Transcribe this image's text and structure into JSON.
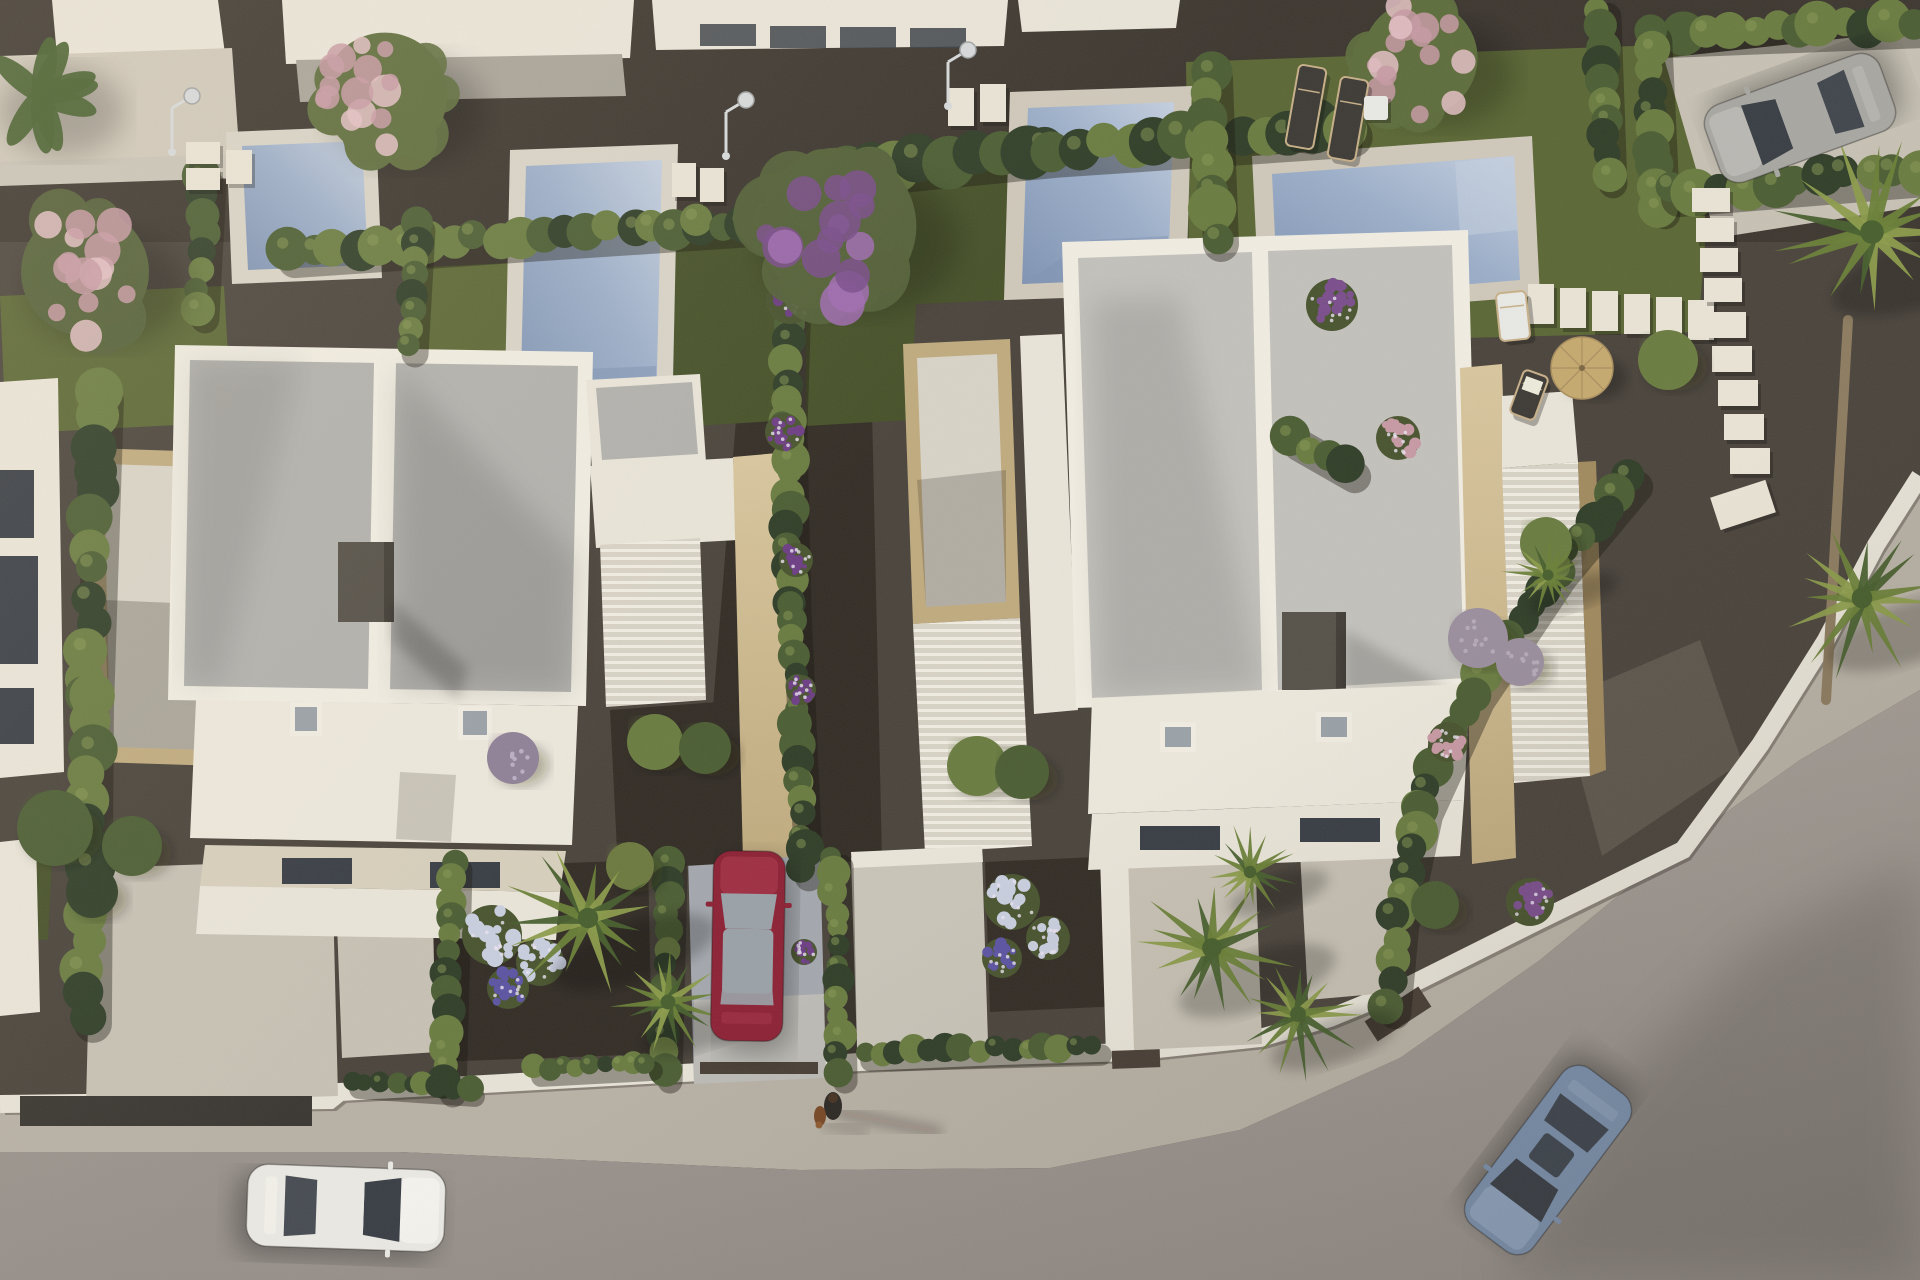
{
  "scene": {
    "title": "Aerial 3D render of a modern villa development at golden hour",
    "description": "Top-down architectural visualization: two white flat-roof villas with travertine pergolas, four private pools with white decks, cypress hedges, lawns, palm trees, flowering shrubs, a curving street corner with sidewalk, four cars and a person walking a dog.",
    "objects_visible": [
      "villa with flat gravel roof (left)",
      "villa with flat gravel roof (right)",
      "4 swimming pools",
      "cypress hedge rows",
      "purple blossom tree",
      "pink blossom trees",
      "fan palms",
      "outdoor showers",
      "sun loungers",
      "straw parasol",
      "stepping-stone paths",
      "red parked car",
      "white car on road",
      "blue car on road",
      "silver car in driveway",
      "person walking a dog",
      "white boundary wall with dark gates",
      "curved sidewalk and asphalt road"
    ]
  },
  "palette": {
    "gravelBase": "#4b453d",
    "gravelDark": "#3e3831",
    "mulch": "#342e27",
    "gravelWarm": "#71685c",
    "grass": "#5c6836",
    "grassShade": "#47522a",
    "grassLight": "#6d7a40",
    "hedgeDark": "#32402a",
    "hedgeMid": "#4d5f35",
    "hedgeLight": "#6b7d42",
    "hedgeGlow": "#8a9a55",
    "treeLeaf": "#5f6e3e",
    "treeLeaf2": "#55623a",
    "bananaLeaf": "#47602f",
    "pinkBloom": "#c79aa4",
    "pinkBloomLight": "#e3bfc4",
    "purpleBloom": "#7b4f8c",
    "purpleBloomLight": "#a06cb0",
    "bougainvillea": "#6e3f85",
    "palmDark": "#49602f",
    "palmMid": "#6b8139",
    "palmLight": "#8c9c4c",
    "palmTrunk": "#8d7c60",
    "lilacBush": "#9b8f9e",
    "lavenderBush": "#8f8197",
    "hydrangeaWhite": "#c9cede",
    "hydrangeaPurple": "#5d55a2",
    "flowerLeaf": "#4a5530",
    "poolWaterLight": "#c4cfdf",
    "poolWater": "#9dafc9",
    "poolWaterDark": "#8094b3",
    "deckWhite": "#d8d3c7",
    "deckWarm": "#cfc8ba",
    "deckBright": "#e9e3d5",
    "terraceStone": "#d7cfbc",
    "parapetWhite": "#f0ece1",
    "wallWhite": "#e9e4d8",
    "wallShade": "#c9c4b8",
    "wallDark": "#a8a399",
    "roofGravelA": "#b2b1ad",
    "roofGravelB": "#c3c1bb",
    "roofWhiteTer": "#ece7db",
    "stoneLight": "#d8c69e",
    "stoneMid": "#c0ab7f",
    "stoneDark": "#a18a5f",
    "slatBase": "#d7d2c5",
    "slatLine": "#f0ece1",
    "chimney": "#57524a",
    "chimneyDark": "#433f38",
    "glassDark": "#3a3f46",
    "skylight": "#9aa1a7",
    "road": "#a59d96",
    "roadDark": "#97908a",
    "sidewalk": "#b8b1a5",
    "curbWhite": "#e7e2d6",
    "driveLight": "#c7c1b4",
    "driveCool": "#a4a8ae",
    "driveCoolLight": "#c2beb6",
    "carRed": "#8d2336",
    "carRedLight": "#a23247",
    "carWhite": "#eae8e2",
    "carWhiteLight": "#f5f3ed",
    "carBlue": "#7b90ab",
    "carBlueLight": "#90a4bd",
    "carSilver": "#a8a7a2",
    "carSilverLight": "#bcbbb6",
    "loungerDark": "#3f3c37",
    "loungerFrame": "#c7b089",
    "parasolStraw": "#c5a96f",
    "tableWhite": "#e8e8e4",
    "gateDark": "#3b3833",
    "gateBrown": "#4a4037",
    "personDark": "#2e2a26",
    "dogBrown": "#7a4a28",
    "showerChrome": "#d6d9da"
  },
  "vegetation": {
    "hedges": [
      {
        "name": "left-boundary-hedge",
        "pts": [
          [
            98,
            392
          ],
          [
            88,
            700
          ],
          [
            86,
            1015
          ]
        ],
        "r": 21,
        "step": 26
      },
      {
        "name": "pool1-left-hedge",
        "pts": [
          [
            205,
            178
          ],
          [
            198,
            310
          ]
        ],
        "r": 16,
        "step": 20
      },
      {
        "name": "top-hedge-left",
        "pts": [
          [
            288,
            252
          ],
          [
            520,
            236
          ],
          [
            700,
            224
          ],
          [
            790,
            218
          ]
        ],
        "r": 19,
        "step": 24
      },
      {
        "name": "pool1-right-hedge",
        "pts": [
          [
            415,
            222
          ],
          [
            408,
            345
          ]
        ],
        "r": 15,
        "step": 20
      },
      {
        "name": "top-hedge-right",
        "pts": [
          [
            845,
            168
          ],
          [
            1050,
            148
          ],
          [
            1345,
            128
          ]
        ],
        "r": 23,
        "step": 28
      },
      {
        "name": "central-hedge",
        "pts": [
          [
            792,
            228
          ],
          [
            786,
            420
          ],
          [
            790,
            600
          ],
          [
            798,
            780
          ],
          [
            802,
            868
          ]
        ],
        "r": 16,
        "step": 20
      },
      {
        "name": "front-hedge-a",
        "pts": [
          [
            452,
            862
          ],
          [
            446,
            1085
          ]
        ],
        "r": 15,
        "step": 19
      },
      {
        "name": "front-hedge-b",
        "pts": [
          [
            668,
            862
          ],
          [
            663,
            1072
          ]
        ],
        "r": 14,
        "step": 18
      },
      {
        "name": "front-hedge-c",
        "pts": [
          [
            834,
            858
          ],
          [
            838,
            1072
          ]
        ],
        "r": 14,
        "step": 18
      },
      {
        "name": "pool3-pool4-hedge",
        "pts": [
          [
            1208,
            70
          ],
          [
            1214,
            235
          ]
        ],
        "r": 20,
        "step": 24
      },
      {
        "name": "villaB-east-hedge",
        "pts": [
          [
            1292,
            436
          ],
          [
            1348,
            468
          ]
        ],
        "r": 18,
        "step": 22
      },
      {
        "name": "right-plot-hedge-v",
        "pts": [
          [
            1600,
            8
          ],
          [
            1606,
            175
          ]
        ],
        "r": 16,
        "step": 20
      },
      {
        "name": "top-right-hedge",
        "pts": [
          [
            1658,
            32
          ],
          [
            1915,
            22
          ]
        ],
        "r": 19,
        "step": 24
      },
      {
        "name": "driveway-hedge-left",
        "pts": [
          [
            1650,
            32
          ],
          [
            1658,
            205
          ]
        ],
        "r": 17,
        "step": 21
      },
      {
        "name": "driveway-hedge-right",
        "pts": [
          [
            1672,
            190
          ],
          [
            1919,
            170
          ]
        ],
        "r": 20,
        "step": 25
      },
      {
        "name": "road-curve-hedge",
        "pts": [
          [
            1630,
            478
          ],
          [
            1555,
            568
          ],
          [
            1472,
            692
          ],
          [
            1420,
            806
          ],
          [
            1396,
            918
          ],
          [
            1388,
            1004
          ]
        ],
        "r": 18,
        "step": 23
      },
      {
        "name": "front-bushes-a",
        "pts": [
          [
            352,
            1080
          ],
          [
            468,
            1088
          ]
        ],
        "r": 11,
        "step": 16
      },
      {
        "name": "front-bushes-b",
        "pts": [
          [
            534,
            1068
          ],
          [
            646,
            1062
          ]
        ],
        "r": 11,
        "step": 16
      },
      {
        "name": "front-bushes-c",
        "pts": [
          [
            864,
            1052
          ],
          [
            1094,
            1046
          ]
        ],
        "r": 12,
        "step": 17
      }
    ],
    "trees": [
      {
        "name": "blossom-tree-top-left",
        "cx": 385,
        "cy": 95,
        "r": 78,
        "leaf": "treeLeaf",
        "flower": "pinkBloom",
        "flower2": "pinkBloomLight"
      },
      {
        "name": "blossom-tree-left",
        "cx": 85,
        "cy": 272,
        "r": 80,
        "leaf": "treeLeaf2",
        "flower": "pinkBloom",
        "flower2": "pinkBloomLight"
      },
      {
        "name": "banana-plants",
        "cx": 40,
        "cy": 95,
        "r": 62,
        "leaf": "bananaLeaf",
        "type": "banana"
      },
      {
        "name": "purple-blossom-tree",
        "cx": 838,
        "cy": 226,
        "r": 98,
        "leaf": "treeLeaf2",
        "flower": "purpleBloom",
        "flower2": "purpleBloomLight"
      },
      {
        "name": "blossom-tree-top-right",
        "cx": 1420,
        "cy": 58,
        "r": 72,
        "leaf": "treeLeaf",
        "flower": "pinkBloom",
        "flower2": "pinkBloomLight"
      }
    ],
    "palms": [
      {
        "name": "palm-frontyard-a1",
        "cx": 588,
        "cy": 918,
        "r": 85
      },
      {
        "name": "palm-frontyard-a2",
        "cx": 668,
        "cy": 1002,
        "r": 62
      },
      {
        "name": "palm-frontyard-b1",
        "cx": 1212,
        "cy": 948,
        "r": 82
      },
      {
        "name": "palm-frontyard-b2",
        "cx": 1298,
        "cy": 1014,
        "r": 66
      },
      {
        "name": "palm-frontyard-b3",
        "cx": 1250,
        "cy": 872,
        "r": 52
      },
      {
        "name": "palm-right-top",
        "cx": 1872,
        "cy": 232,
        "r": 98,
        "trunk": [
          [
            1848,
            320
          ],
          [
            1826,
            700
          ]
        ]
      },
      {
        "name": "palm-right-mid",
        "cx": 1862,
        "cy": 598,
        "r": 86
      },
      {
        "name": "palm-small-right",
        "cx": 1548,
        "cy": 575,
        "r": 46
      }
    ],
    "bushes": [
      {
        "name": "backyard-bush-1",
        "cx": 55,
        "cy": 828,
        "r": 38,
        "color": "hedgeMid"
      },
      {
        "name": "backyard-bush-2",
        "cx": 132,
        "cy": 846,
        "r": 30,
        "color": "hedgeMid"
      },
      {
        "name": "backyard-bush-3",
        "cx": 92,
        "cy": 892,
        "r": 26,
        "color": "hedgeDark"
      },
      {
        "name": "villaA-planter-bush-1",
        "cx": 655,
        "cy": 742,
        "r": 28,
        "color": "hedgeLight"
      },
      {
        "name": "villaA-planter-bush-2",
        "cx": 705,
        "cy": 748,
        "r": 26,
        "color": "hedgeMid"
      },
      {
        "name": "villaB-planter-bush-1",
        "cx": 977,
        "cy": 766,
        "r": 30,
        "color": "hedgeLight"
      },
      {
        "name": "villaB-planter-bush-2",
        "cx": 1022,
        "cy": 772,
        "r": 27,
        "color": "hedgeMid"
      },
      {
        "name": "lavender-ball-bush",
        "cx": 513,
        "cy": 758,
        "r": 26,
        "color": "lavenderBush",
        "dots": "#b9aec4"
      },
      {
        "name": "right-garden-bush-1",
        "cx": 1668,
        "cy": 360,
        "r": 30,
        "color": "hedgeLight"
      },
      {
        "name": "right-garden-bush-2",
        "cx": 1546,
        "cy": 543,
        "r": 26,
        "color": "hedgeLight"
      },
      {
        "name": "lilac-bush-1",
        "cx": 1478,
        "cy": 638,
        "r": 30,
        "color": "lilacBush",
        "dots": "#b5a9b8"
      },
      {
        "name": "lilac-bush-2",
        "cx": 1520,
        "cy": 662,
        "r": 24,
        "color": "lilacBush",
        "dots": "#b5a9b8"
      },
      {
        "name": "road-curve-bush",
        "cx": 1435,
        "cy": 905,
        "r": 24,
        "color": "hedgeMid"
      },
      {
        "name": "yucca-bush",
        "cx": 630,
        "cy": 866,
        "r": 24,
        "color": "grassLight"
      }
    ],
    "flowers": [
      {
        "name": "purple-flower-bush-1",
        "cx": 1332,
        "cy": 305,
        "r": 26,
        "color": "purpleBloom"
      },
      {
        "name": "pink-flower-bush-1",
        "cx": 1398,
        "cy": 438,
        "r": 22,
        "color": "pinkBloom"
      },
      {
        "name": "pink-flower-bush-2",
        "cx": 1448,
        "cy": 742,
        "r": 20,
        "color": "pinkBloom"
      },
      {
        "name": "purple-flower-bush-2",
        "cx": 1530,
        "cy": 902,
        "r": 24,
        "color": "purpleBloom"
      },
      {
        "name": "bougainvillea-1",
        "cx": 790,
        "cy": 300,
        "r": 24,
        "color": "bougainvillea"
      },
      {
        "name": "bougainvillea-2",
        "cx": 784,
        "cy": 432,
        "r": 19,
        "color": "bougainvillea"
      },
      {
        "name": "bougainvillea-3",
        "cx": 796,
        "cy": 560,
        "r": 17,
        "color": "bougainvillea"
      },
      {
        "name": "bougainvillea-4",
        "cx": 801,
        "cy": 690,
        "r": 15,
        "color": "bougainvillea"
      },
      {
        "name": "bougainvillea-5",
        "cx": 804,
        "cy": 952,
        "r": 13,
        "color": "bougainvillea"
      },
      {
        "name": "hydrangea-a-1",
        "cx": 492,
        "cy": 935,
        "r": 30,
        "color": "hydrangeaWhite"
      },
      {
        "name": "hydrangea-a-2",
        "cx": 540,
        "cy": 962,
        "r": 24,
        "color": "hydrangeaWhite"
      },
      {
        "name": "hydrangea-a-3",
        "cx": 508,
        "cy": 988,
        "r": 21,
        "color": "hydrangeaPurple"
      },
      {
        "name": "hydrangea-b-1",
        "cx": 1012,
        "cy": 902,
        "r": 28,
        "color": "hydrangeaWhite"
      },
      {
        "name": "hydrangea-b-2",
        "cx": 1048,
        "cy": 938,
        "r": 22,
        "color": "hydrangeaWhite"
      },
      {
        "name": "hydrangea-b-3",
        "cx": 1002,
        "cy": 958,
        "r": 20,
        "color": "hydrangeaPurple"
      }
    ],
    "stones": [
      {
        "x": 186,
        "y": 142,
        "w": 34,
        "h": 22
      },
      {
        "x": 186,
        "y": 168,
        "w": 34,
        "h": 22
      },
      {
        "x": 226,
        "y": 150,
        "w": 26,
        "h": 34
      },
      {
        "x": 672,
        "y": 163,
        "w": 24,
        "h": 34
      },
      {
        "x": 700,
        "y": 168,
        "w": 24,
        "h": 34
      },
      {
        "x": 948,
        "y": 88,
        "w": 26,
        "h": 38
      },
      {
        "x": 980,
        "y": 84,
        "w": 26,
        "h": 38
      },
      {
        "x": 1528,
        "y": 284,
        "w": 26,
        "h": 40
      },
      {
        "x": 1560,
        "y": 288,
        "w": 26,
        "h": 40
      },
      {
        "x": 1592,
        "y": 291,
        "w": 26,
        "h": 40
      },
      {
        "x": 1624,
        "y": 294,
        "w": 26,
        "h": 40
      },
      {
        "x": 1656,
        "y": 297,
        "w": 26,
        "h": 40
      },
      {
        "x": 1688,
        "y": 300,
        "w": 26,
        "h": 40
      },
      {
        "x": 1692,
        "y": 188,
        "w": 38,
        "h": 24
      },
      {
        "x": 1696,
        "y": 218,
        "w": 38,
        "h": 24
      },
      {
        "x": 1700,
        "y": 248,
        "w": 38,
        "h": 24
      },
      {
        "x": 1704,
        "y": 278,
        "w": 38,
        "h": 24
      },
      {
        "x": 1706,
        "y": 312,
        "w": 40,
        "h": 26
      },
      {
        "x": 1712,
        "y": 346,
        "w": 40,
        "h": 26
      },
      {
        "x": 1718,
        "y": 380,
        "w": 40,
        "h": 26
      },
      {
        "x": 1724,
        "y": 414,
        "w": 40,
        "h": 26
      },
      {
        "x": 1730,
        "y": 448,
        "w": 40,
        "h": 26
      },
      {
        "x": 1714,
        "y": 488,
        "w": 58,
        "h": 34,
        "rot": -18
      }
    ]
  },
  "furniture": {
    "loungers": [
      {
        "name": "sun-lounger-1",
        "x": 1292,
        "y": 66,
        "w": 28,
        "h": 82,
        "rot": 10,
        "color": "loungerDark"
      },
      {
        "name": "sun-lounger-2",
        "x": 1334,
        "y": 78,
        "w": 28,
        "h": 82,
        "rot": 10,
        "color": "loungerDark"
      },
      {
        "name": "pool-chair-white",
        "x": 1498,
        "y": 292,
        "w": 30,
        "h": 48,
        "rot": -6,
        "color": "tableWhite"
      },
      {
        "name": "deck-chair",
        "x": 1516,
        "y": 372,
        "w": 26,
        "h": 46,
        "rot": 20,
        "color": "loungerDark",
        "towel": true
      }
    ],
    "sideTable": {
      "x": 1364,
      "y": 96,
      "w": 24,
      "h": 24
    },
    "parasol": {
      "cx": 1582,
      "cy": 368,
      "r": 31
    },
    "showers": [
      {
        "x": 172,
        "y": 108
      },
      {
        "x": 726,
        "y": 112
      },
      {
        "x": 948,
        "y": 62
      }
    ]
  },
  "actors": {
    "cars": [
      {
        "name": "car-red-parked",
        "cx": 748,
        "cy": 946,
        "rot": 1,
        "len": 190,
        "w": 72,
        "body": "carRed",
        "bodyLight": "carRedLight",
        "glass": "skylight",
        "glassRoof": true
      },
      {
        "name": "car-white-road",
        "cx": 346,
        "cy": 1208,
        "rot": 92,
        "len": 198,
        "w": 82,
        "body": "carWhite",
        "bodyLight": "carWhiteLight",
        "glass": "glassDark"
      },
      {
        "name": "car-blue-road",
        "cx": 1548,
        "cy": 1160,
        "rot": 217,
        "len": 196,
        "w": 82,
        "body": "carBlue",
        "bodyLight": "carBlueLight",
        "glass": "glassDark",
        "sunroof": true
      },
      {
        "name": "car-silver-driveway",
        "cx": 1800,
        "cy": 118,
        "rot": 250,
        "len": 186,
        "w": 82,
        "body": "carSilver",
        "bodyLight": "carSilverLight",
        "glass": "glassDark"
      }
    ],
    "pedestrian": {
      "x": 833,
      "y": 1098,
      "shadowLen": 105,
      "dog": {
        "x": 820,
        "y": 1116
      }
    }
  }
}
